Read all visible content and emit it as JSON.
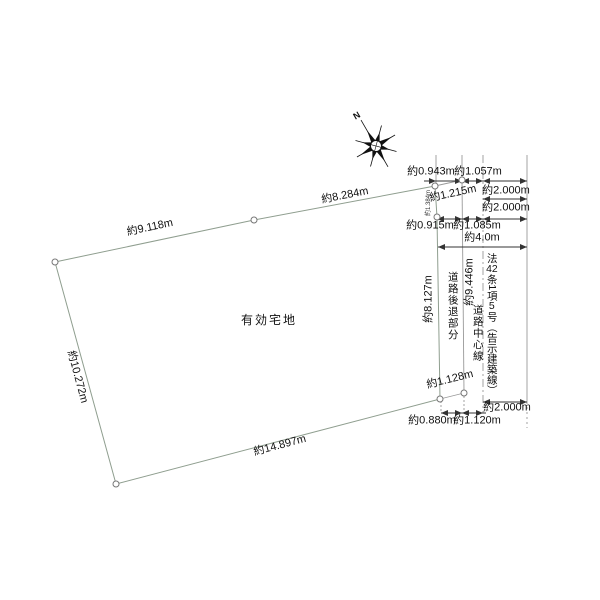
{
  "parcel": {
    "area_label": "有効宅地",
    "edge_top_left": "約9.118m",
    "edge_top_right": "約8.284m",
    "edge_left": "約10.272m",
    "edge_bottom": "約14.897m",
    "edge_right": "約8.127m",
    "edge_right_small": "約1.384m"
  },
  "compass": {
    "north_label": "N"
  },
  "setback": {
    "strip_label": "道路後退部分",
    "top_remnant": "約1.215m",
    "bottom_remnant": "約1.128m",
    "boundary_length": "約9.446m"
  },
  "road": {
    "centerline_label": "道路中心線",
    "width_label": "約4.0m",
    "legal_parts": [
      "法",
      "42",
      "条",
      "1",
      "項",
      "5",
      "号（告示建築線）"
    ]
  },
  "dims_top": {
    "row1_left": "約0.943m",
    "row1_right": "約1.057m",
    "row2_offset": "約2.000m",
    "row3_offset": "約2.000m",
    "row4_left": "約0.915m",
    "row4_right": "約1.085m"
  },
  "dims_bottom": {
    "left": "約0.880m",
    "right": "約1.120m",
    "offset": "約2.000m"
  },
  "colors": {
    "parcel_fill": "#d9eed7",
    "parcel_stroke": "#8f9e8f",
    "dim_line": "#333333",
    "aux_line": "#999999"
  }
}
